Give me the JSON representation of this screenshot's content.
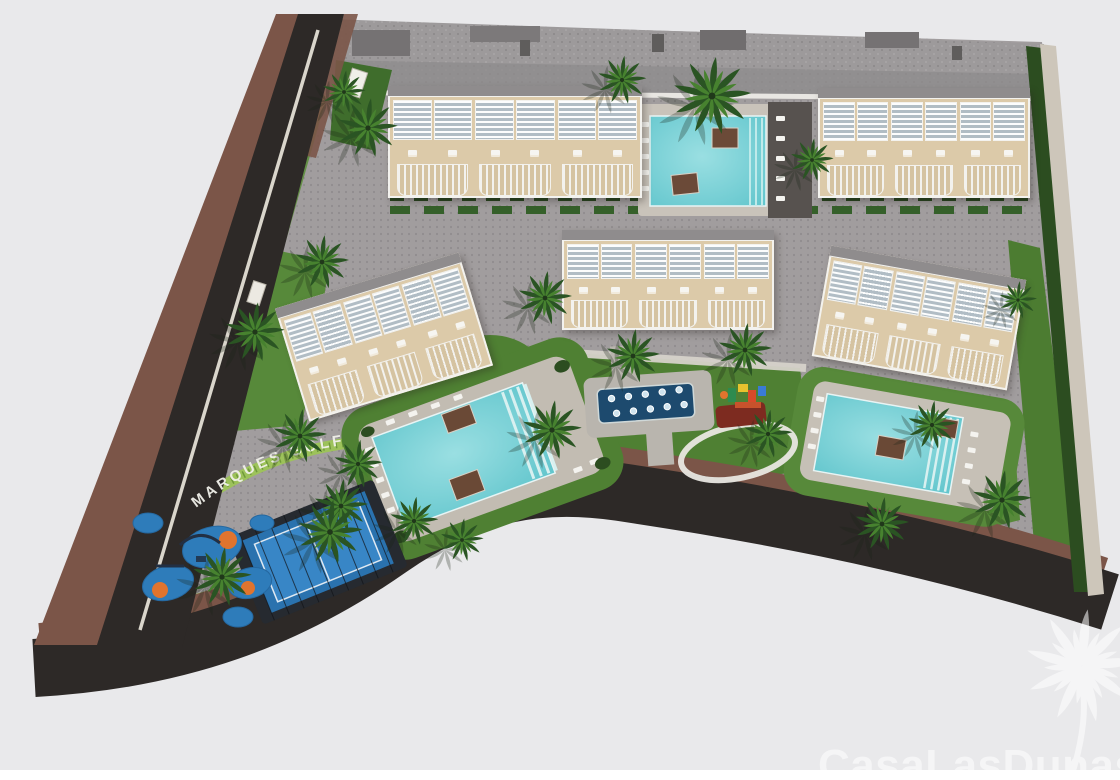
{
  "scene": {
    "type": "aerial-3d-render",
    "subject": "Bird's-eye architectural render of a residential resort development: five townhouse blocks, three swimming pools, splash pad, playgrounds, padel court, palm gardens, bounded by roads"
  },
  "labels": {
    "street_sign": "MARQUES GOLF"
  },
  "watermark": {
    "brand": "CasaLasDunas"
  },
  "palette": {
    "background": "#e9e9eb",
    "asphalt": "#2d2927",
    "sidewalk": "#7b5548",
    "paving": "#a19d9e",
    "lawn": "#4f8033",
    "lawn2": "#57893a",
    "hedge": "#2c4d20",
    "pool_water": "#7fd2d6",
    "splash_pool": "#1d4a6e",
    "padel_court": "#2a72ae",
    "play_surface": "#2e7cba",
    "play_accent": "#e0742e",
    "building_wall": "#dccaa9",
    "building_trim": "#f3f2ee",
    "roof": "#8f8c8d"
  }
}
